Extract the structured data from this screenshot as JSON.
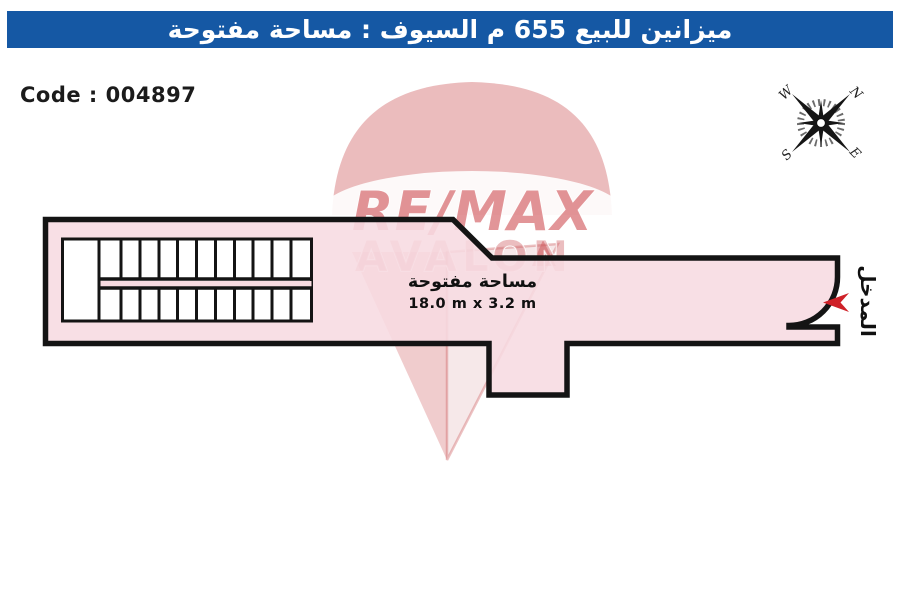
{
  "header": {
    "title": "ميزانين للبيع 655 م السيوف : مساحة مفتوحة"
  },
  "code_label": "Code : 004897",
  "compass": {
    "nw": "W",
    "ne": "N",
    "sw": "S",
    "se": "E"
  },
  "watermark": {
    "brand": "RE/MAX",
    "name": "AVALON"
  },
  "plan": {
    "area_label": "مساحة مفتوحة",
    "dimensions": "18.0 m x 3.2 m",
    "entrance_label": "المدخل"
  },
  "colors": {
    "banner_blue": "#1558a4",
    "plan_fill": "#f7dbe1",
    "outline": "#141414",
    "arrow_red": "#cf2128"
  }
}
